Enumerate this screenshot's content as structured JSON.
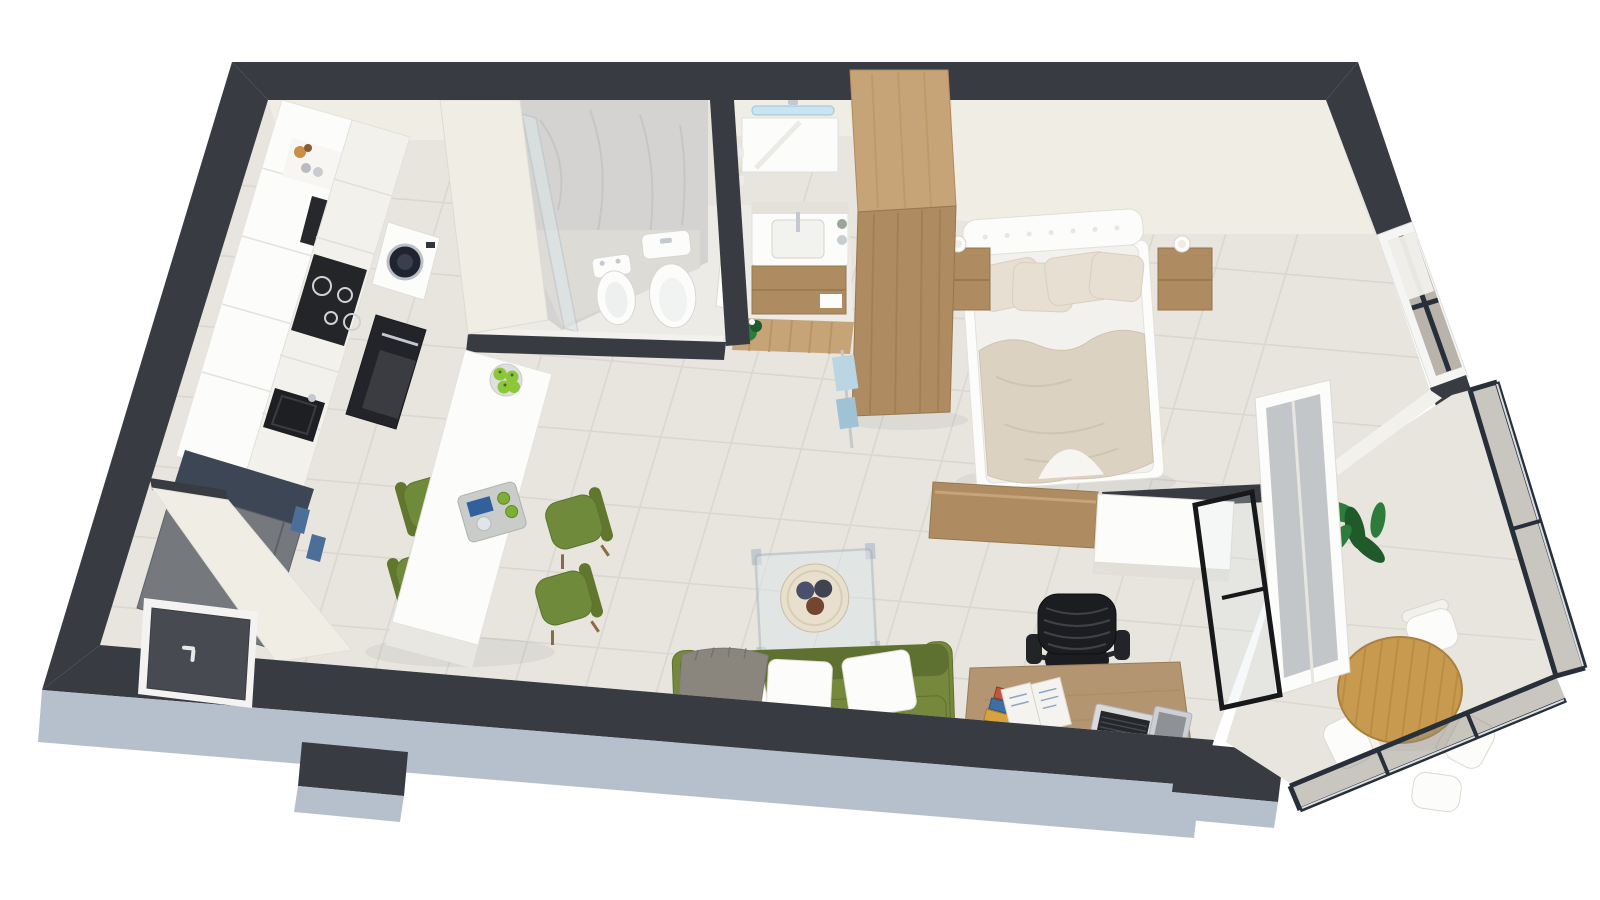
{
  "meta": {
    "title": "3D isometric floor plan render — studio apartment cutaway, top-down view on white background",
    "image_has_text": false
  },
  "palette": {
    "wall": "#383c42",
    "doorleaf": "#474a50",
    "exterior": "#b6c0cd",
    "floor": "#e8e5df",
    "grout": "#d6d2cb",
    "floorbath": "#edebe5",
    "cream": "#f0ede5",
    "creamshade": "#e4e1d8",
    "white": "#f2f1ec",
    "purewhite": "#fcfcfa",
    "marble": "#d4d3d1",
    "glass": "#dce6ea",
    "glasstint": "#948d80",
    "frame": "#272f3a",
    "silver": "#c3c9ce",
    "wood": "#ae8b61",
    "woodlight": "#c6a478",
    "wooddesk": "#b49571",
    "woodtable": "#c89a4f",
    "greensofa": "#75883c",
    "greendark": "#5f7130",
    "greenchair": "#6e8a3a",
    "apple": "#8cc63c",
    "bedding": "#dcd2c2",
    "pillow": "#e7dfd1",
    "graythrow": "#8a867e",
    "black": "#1c1d20",
    "appliance": "#232529",
    "fridge": "#75797e",
    "fridgetop": "#3c4654",
    "handleblue": "#4c6f9a",
    "led": "#c9e4f2",
    "plant": "#2e7c3c",
    "plantdark": "#205a2b",
    "paper": "#f5f3ef"
  },
  "scene": {
    "view": "isometric 3D cutaway floor plan, walls in dark charcoal, cut faces in light blue-gray",
    "background": "#ffffff",
    "rooms": [
      {
        "id": "kitchen",
        "label": "Kitchen",
        "items": [
          "white cabinet run along wall",
          "open shelf with cups and dried plant",
          "built-in microwave",
          "induction cooktop with 4 burners",
          "washing machine with round door",
          "black oven column",
          "black undermount sink",
          "gray refrigerator with blue handles"
        ]
      },
      {
        "id": "dining",
        "label": "Dining island",
        "items": [
          "long white island table",
          "4 olive-green chairs with wood legs",
          "bowl of green apples",
          "gray serving tray with drinks"
        ]
      },
      {
        "id": "bathroom",
        "label": "Bathroom",
        "items": [
          "marble walk-in shower with glass screen",
          "bidet",
          "toilet",
          "vanity washbasin",
          "mirror with LED light bar",
          "under-sink wood cabinet",
          "wood slat mat",
          "small plant",
          "white door ajar"
        ]
      },
      {
        "id": "bedroom",
        "label": "Bedroom",
        "items": [
          "double bed with white tufted headboard",
          "beige duvet and pillows",
          "2 wooden nightstands with white cups",
          "tall wooden wardrobe",
          "hanging towels",
          "wooden dresser at bed foot",
          "white sideboard",
          "black-grid window with white frame",
          "white roller shade"
        ]
      },
      {
        "id": "living",
        "label": "Living area",
        "items": [
          "olive-green two-seat sofa",
          "3 white cushions",
          "gray throw blanket",
          "glass coffee table with steel legs",
          "rattan tray with decorative balls",
          "wooden desk",
          "stack of magazines",
          "open booklet",
          "open laptop",
          "black mug with pencils",
          "black mesh office chair"
        ]
      },
      {
        "id": "balcony",
        "label": "Balcony",
        "items": [
          "glass railing with dark frame",
          "round wooden bistro table",
          "white folding chairs",
          "potted green plant",
          "open glass door with white frame",
          "black-framed glass partition door"
        ]
      },
      {
        "id": "entrance",
        "label": "Entrance",
        "items": [
          "dark entry door with white frame and handle",
          "entry hallway wall"
        ]
      }
    ],
    "counts": {
      "dining_chairs": 4,
      "bed_pillows": 4,
      "sofa_cushions": 3,
      "balcony_chairs": 4,
      "cooktop_burners": 4
    }
  }
}
